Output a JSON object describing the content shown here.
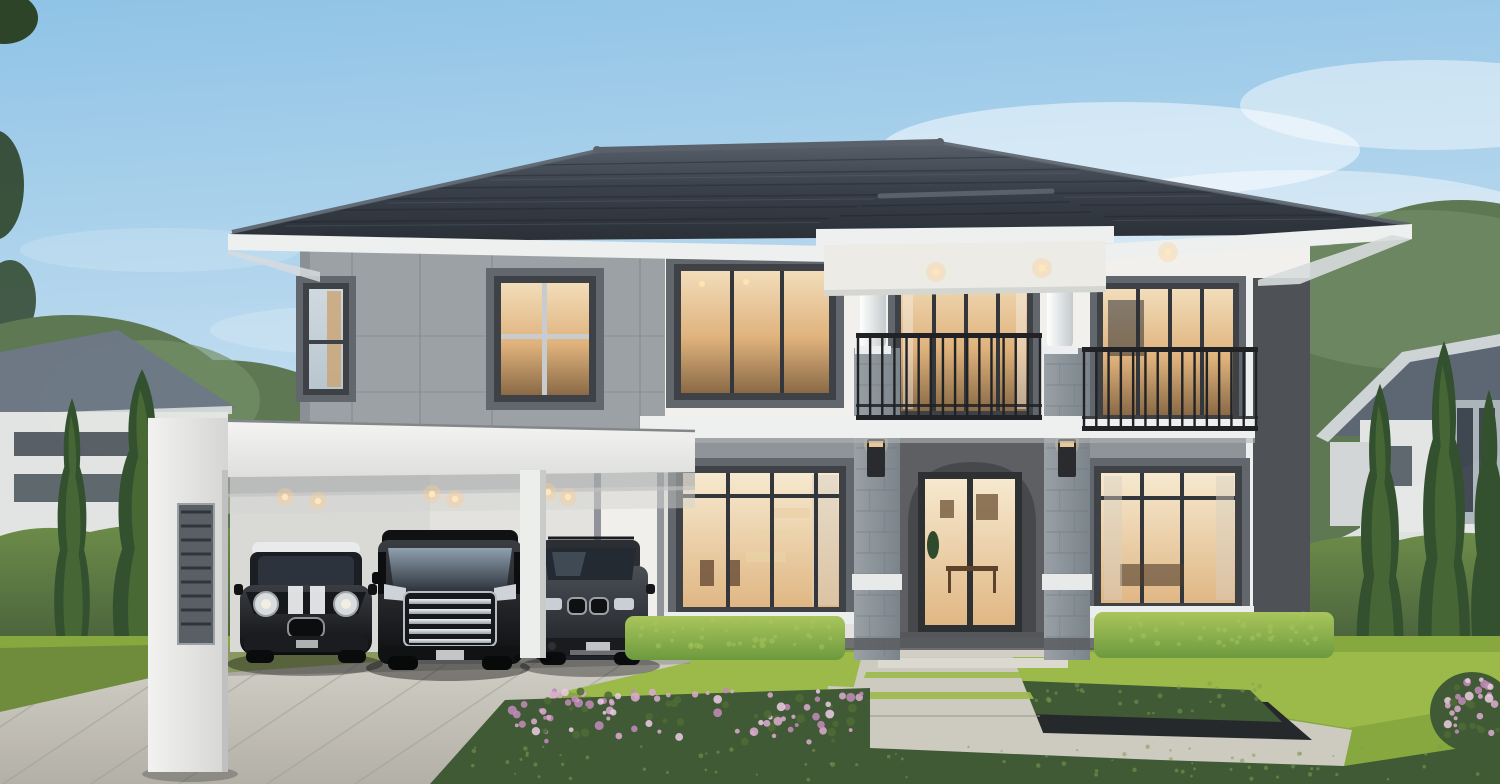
{
  "scene": {
    "type": "architectural-exterior-rendering",
    "description": "Photorealistic rendering of a modern two-story luxury house at dusk: dark tiled hip roof, white and grey facade, stone entrance piers with wall lamps, two balconies with black railings, white carport sheltering three black cars, paved driveway, front lawn with trimmed hedges, cypress trees, pink flower beds and neighboring houses under a blue evening sky",
    "time_of_day": "early evening",
    "elements": [
      "sky with soft clouds",
      "background trees",
      "neighbor house left",
      "neighbor house right",
      "perimeter hedge",
      "cypress trees",
      "main house",
      "hip tile roof",
      "portico with round columns",
      "stone piers",
      "wall lamps",
      "center balcony",
      "right balcony",
      "glass entrance door",
      "lit interior windows",
      "carport with downlights",
      "mini hatchback",
      "luxury minivan",
      "suv",
      "paved driveway",
      "front lawn",
      "trimmed hedge boxes",
      "sunken planter",
      "walkway with steps",
      "flower beds",
      "ground cover"
    ],
    "cars": [
      {
        "name": "mini-hatchback",
        "color": "black with white roof and bonnet stripes"
      },
      {
        "name": "luxury-minivan",
        "color": "black with chrome multi-bar grille"
      },
      {
        "name": "suv",
        "color": "dark grey with kidney grille"
      }
    ]
  },
  "palette": {
    "sky_top": "#8fc3e6",
    "sky_mid": "#c3def0",
    "sky_horizon": "#e9e5d9",
    "cloud": "#ffffff",
    "roof_dark": "#2a2f36",
    "roof_mid": "#39404a",
    "roof_light": "#565e69",
    "ridge": "#5a616b",
    "fascia": "#eef0f0",
    "soffit": "#d7dbdd",
    "wall_white": "#f1f0ed",
    "wall_shade": "#e3e2df",
    "panel_gray": "#9ba1a5",
    "band_gray": "#8f9498",
    "frame_dark": "#3e4246",
    "casing_gray": "#61676d",
    "glass_cool": "#b9c6cf",
    "interior_warm": "#dfb27c",
    "interior_bright": "#f6e9cf",
    "interior_deep": "#8a6a46",
    "stone": "#8d959b",
    "stone_line": "#6f777d",
    "stone_band": "#e8eae9",
    "column_hi": "#ffffff",
    "column_sh": "#c4cacd",
    "railing": "#202225",
    "accent_band": "#4e5256",
    "arch_wall": "#5d5f63",
    "arch_inner": "#46484c",
    "porch_dark": "#55575a",
    "lamp": "#292b2e",
    "lamp_glow": "#ffcf8e",
    "slab_white": "#f3f3f1",
    "slab_shadow": "#a9acad",
    "hedge_top": "#6c8c49",
    "hedge_dark": "#43593a",
    "hedgebox_hi": "#a9c55c",
    "hedgebox": "#6d9a3e",
    "lawn": "#86a83e",
    "lawn_light": "#9cba4a",
    "lawn_shade": "#6f8c3c",
    "groundcover": "#3f5a34",
    "groundcover_hi": "#7f9c52",
    "flower_a": "#d9aace",
    "flower_b": "#c08ab8",
    "flower_c": "#eac9e2",
    "flower_leaf": "#4e6b35",
    "cypress_dark": "#33512e",
    "cypress_hi": "#5a7d3b",
    "tree_bg": "#5d7852",
    "tree_bg_hi": "#75906a",
    "leaf_dark": "#2e4429",
    "neighbor_wall": "#e7e9e8",
    "neighbor_roof": "#6e7987",
    "neighbor_roof_r": "#5d6775",
    "neighbor_win": "#3f4750",
    "drive_light": "#d5d2c9",
    "drive_dark": "#b3b0a8",
    "drive_line": "#a19e96",
    "walk": "#cdcac0",
    "planter": "#26292c",
    "car_black_hi": "#3a3d42",
    "car_black": "#0d0e10",
    "car_gray_hi": "#4a4f56",
    "car_gray": "#1e2125",
    "chrome_hi": "#eef1f3",
    "chrome": "#9aa2a8",
    "glass_car": "#2b313a",
    "wind_refl": "#8fa0ae",
    "white_trim": "#e9eaeb"
  },
  "decor": {
    "railings": [
      {
        "id": "railing-center-bars",
        "x": 858,
        "y": 336,
        "width": 182,
        "height": 84,
        "bars": 16
      },
      {
        "id": "railing-right-bars",
        "x": 1084,
        "y": 350,
        "width": 172,
        "height": 80,
        "bars": 15
      }
    ],
    "downlights": [
      {
        "id": "dl-carport",
        "points": [
          [
            285,
            497
          ],
          [
            318,
            501
          ],
          [
            432,
            494
          ],
          [
            455,
            499
          ],
          [
            548,
            492
          ],
          [
            568,
            497
          ]
        ],
        "r": 3.2,
        "halo": 9
      },
      {
        "id": "dl-portico",
        "points": [
          [
            936,
            272
          ],
          [
            1042,
            268
          ],
          [
            1168,
            252
          ]
        ],
        "r": 3.6,
        "halo": 10
      }
    ],
    "drive_lines": {
      "id": "drive-lines",
      "count": 9,
      "x0": 130,
      "spacing": 88,
      "slant": -215,
      "y_top": 640,
      "y_bottom": 784
    },
    "stone_piers": [
      [
        854,
        348,
        46,
        312
      ],
      [
        1044,
        348,
        46,
        312
      ]
    ],
    "louver": {
      "id": "louver-slats",
      "x": 181,
      "y": 512,
      "width": 30,
      "count": 9,
      "step": 14
    },
    "dots": [
      {
        "id": "gc-dots",
        "x": 470,
        "y": 746,
        "w": 1020,
        "h": 34,
        "count": 80,
        "r_min": 1,
        "r_max": 2.4,
        "color": "groundcover_hi",
        "opacity": 0.55
      },
      {
        "id": "planter-dots",
        "x": 955,
        "y": 682,
        "w": 310,
        "h": 32,
        "count": 36,
        "r_min": 1.2,
        "r_max": 2.6,
        "color": "groundcover_hi",
        "opacity": 0.5
      },
      {
        "id": "hedgeL-dots",
        "x": 632,
        "y": 618,
        "w": 206,
        "h": 30,
        "count": 40,
        "r_min": 1.5,
        "r_max": 3,
        "color": "hedgebox_hi",
        "opacity": 0.5
      },
      {
        "id": "hedgeR-dots",
        "x": 1098,
        "y": 614,
        "w": 228,
        "h": 32,
        "count": 40,
        "r_min": 1.5,
        "r_max": 3,
        "color": "hedgebox_hi",
        "opacity": 0.5
      }
    ],
    "flowers": [
      {
        "id": "flowers-left",
        "x": 505,
        "y": 690,
        "w": 358,
        "h": 52,
        "count": 110
      },
      {
        "id": "flowers-right",
        "x": 1444,
        "y": 678,
        "w": 56,
        "h": 60,
        "count": 34
      }
    ]
  }
}
